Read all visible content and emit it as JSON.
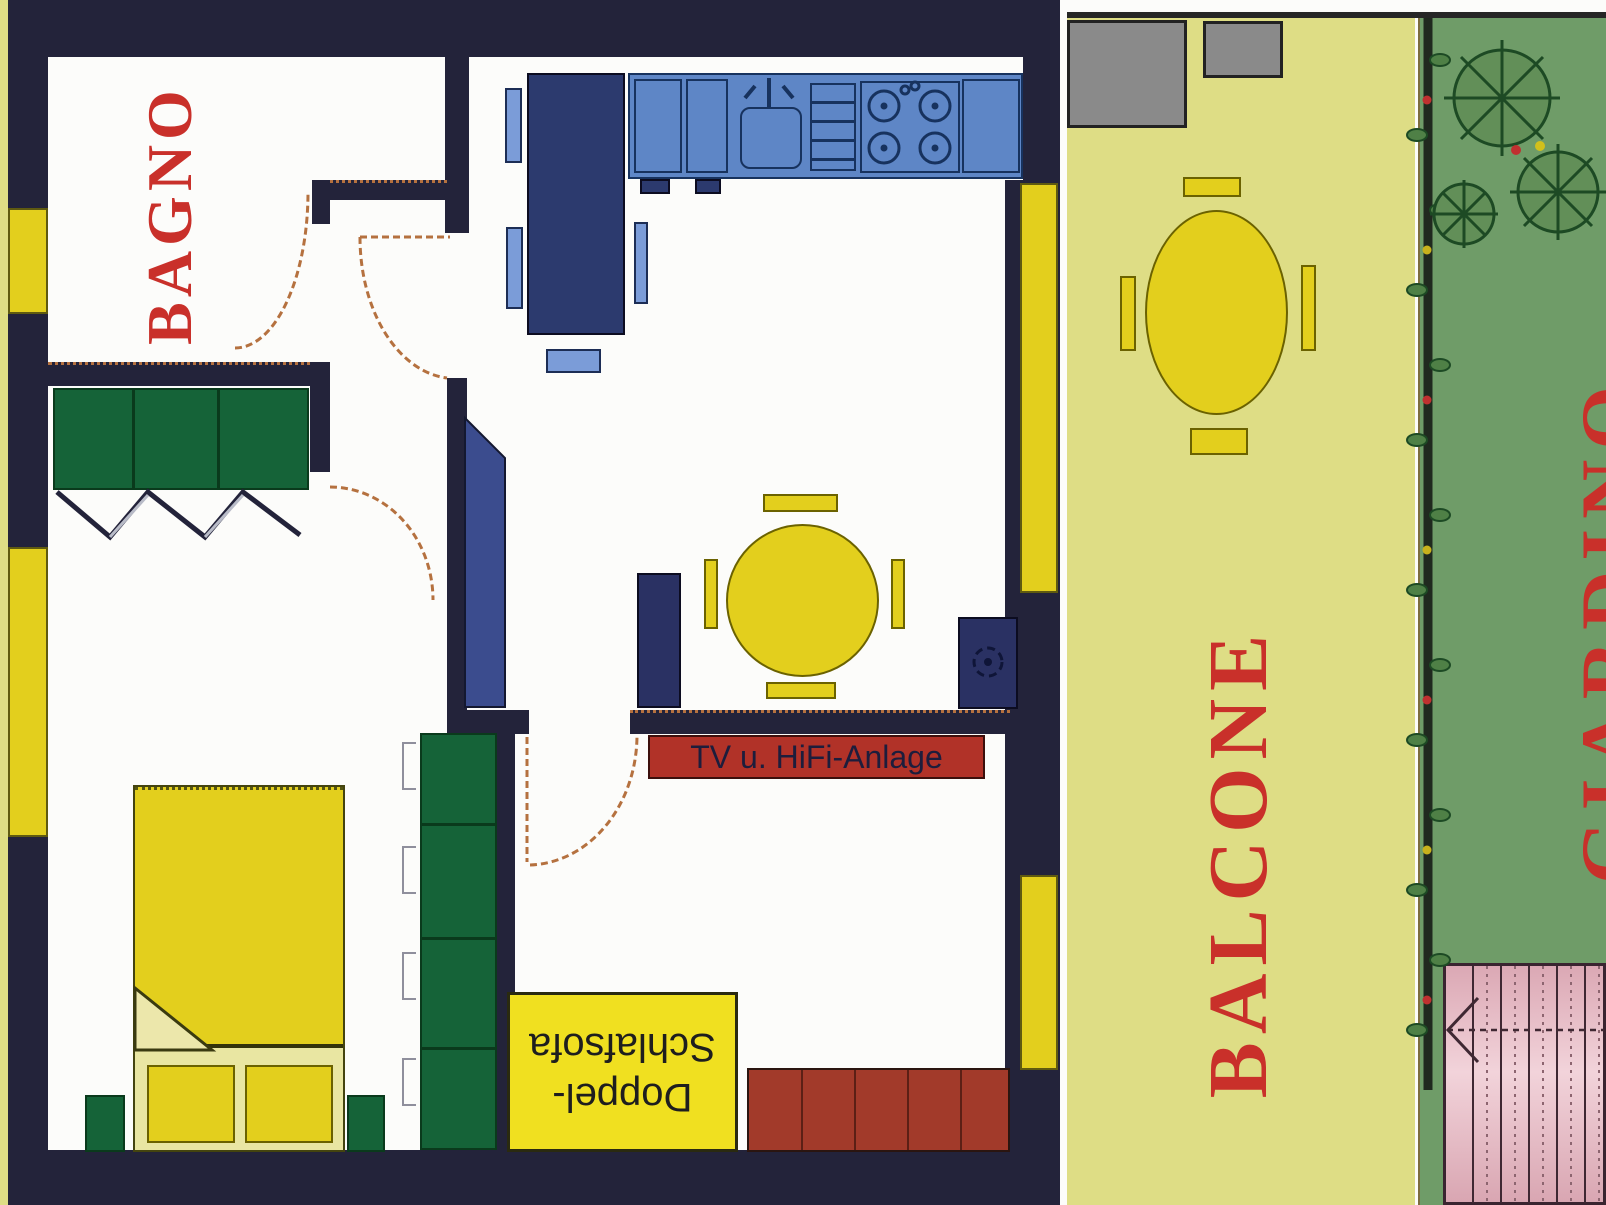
{
  "labels": {
    "bathroom": "BAGNO",
    "balcony": "BALCONE",
    "garden": "GIARDINO",
    "tv": "TV u. HiFi-Anlage",
    "sofa_line1": "Doppel-",
    "sofa_line2": "Schlafsofa"
  },
  "colors": {
    "wall": "#23233a",
    "room_label": "#c9302a",
    "furniture_yellow": "#e3cf1d",
    "pale_yellow": "#dedd85",
    "kitchen_blue": "#5e86c6",
    "navy_furniture": "#2c3a6e",
    "chair_blue": "#7b9cd8",
    "green_furniture": "#156338",
    "sofa_red": "#a23a2a",
    "tv_red": "#b13228",
    "garden_green": "#6f9c68",
    "stairs_pink": "#e5b9c2",
    "planter_gray": "#8a8a8a",
    "door_arc": "#b5713f"
  }
}
